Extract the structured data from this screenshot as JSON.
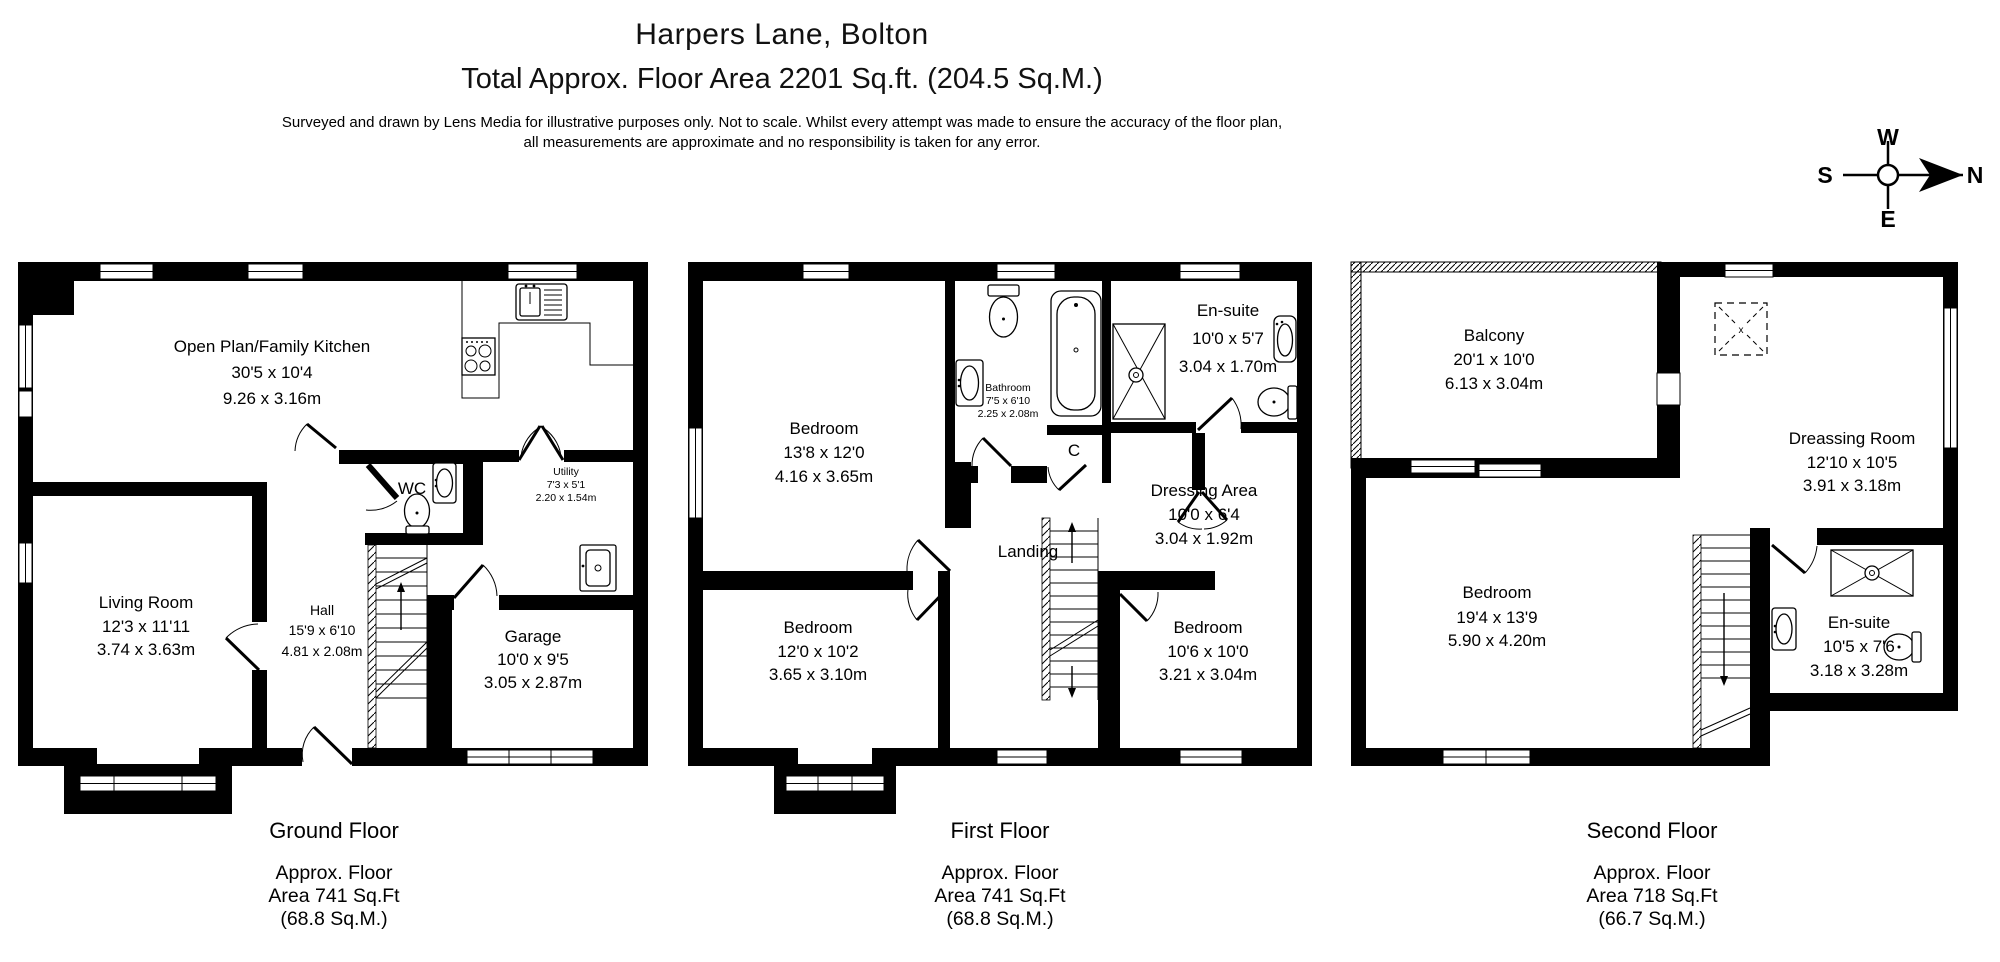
{
  "header": {
    "title": "Harpers Lane, Bolton",
    "subtitle": "Total Approx. Floor Area 2201 Sq.ft. (204.5 Sq.M.)",
    "disclaimer_line1": "Surveyed and drawn by Lens Media for illustrative purposes only. Not to scale. Whilst every attempt was made to ensure the accuracy of the floor plan,",
    "disclaimer_line2": "all measurements are approximate and no responsibility is taken for any error."
  },
  "compass": {
    "north": "N",
    "south": "S",
    "east": "E",
    "west": "W"
  },
  "floors": [
    {
      "name": "Ground Floor",
      "area": [
        "Approx. Floor",
        "Area 741 Sq.Ft",
        "(68.8 Sq.M.)"
      ],
      "rooms": {
        "kitchen": {
          "name": "Open Plan/Family Kitchen",
          "imp": "30'5 x 10'4",
          "met": "9.26 x 3.16m"
        },
        "living": {
          "name": "Living Room",
          "imp": "12'3 x 11'11",
          "met": "3.74 x 3.63m"
        },
        "hall": {
          "name": "Hall",
          "imp": "15'9 x 6'10",
          "met": "4.81 x 2.08m"
        },
        "garage": {
          "name": "Garage",
          "imp": "10'0 x 9'5",
          "met": "3.05 x 2.87m"
        },
        "wc": {
          "name": "WC"
        },
        "utility": {
          "name": "Utility",
          "imp": "7'3 x 5'1",
          "met": "2.20 x 1.54m"
        }
      }
    },
    {
      "name": "First Floor",
      "area": [
        "Approx. Floor",
        "Area 741 Sq.Ft",
        "(68.8 Sq.M.)"
      ],
      "rooms": {
        "bedroom1": {
          "name": "Bedroom",
          "imp": "13'8 x 12'0",
          "met": "4.16 x 3.65m"
        },
        "bathroom": {
          "name": "Bathroom",
          "imp": "7'5 x 6'10",
          "met": "2.25 x 2.08m"
        },
        "ensuite": {
          "name": "En-suite",
          "imp": "10'0 x 5'7",
          "met": "3.04 x 1.70m"
        },
        "dressing": {
          "name": "Dressing Area",
          "imp": "10'0 x 6'4",
          "met": "3.04 x 1.92m"
        },
        "landing": {
          "name": "Landing"
        },
        "cupboard": {
          "name": "C"
        },
        "bedroom2": {
          "name": "Bedroom",
          "imp": "12'0 x 10'2",
          "met": "3.65 x 3.10m"
        },
        "bedroom3": {
          "name": "Bedroom",
          "imp": "10'6 x 10'0",
          "met": "3.21 x 3.04m"
        }
      }
    },
    {
      "name": "Second Floor",
      "area": [
        "Approx. Floor",
        "Area 718 Sq.Ft",
        "(66.7 Sq.M.)"
      ],
      "rooms": {
        "balcony": {
          "name": "Balcony",
          "imp": "20'1 x 10'0",
          "met": "6.13 x 3.04m"
        },
        "dressing": {
          "name": "Dreassing Room",
          "imp": "12'10 x 10'5",
          "met": "3.91 x 3.18m"
        },
        "bedroom": {
          "name": "Bedroom",
          "imp": "19'4 x 13'9",
          "met": "5.90 x 4.20m"
        },
        "ensuite": {
          "name": "En-suite",
          "imp": "10'5 x 7'6",
          "met": "3.18 x 3.28m"
        }
      }
    }
  ]
}
